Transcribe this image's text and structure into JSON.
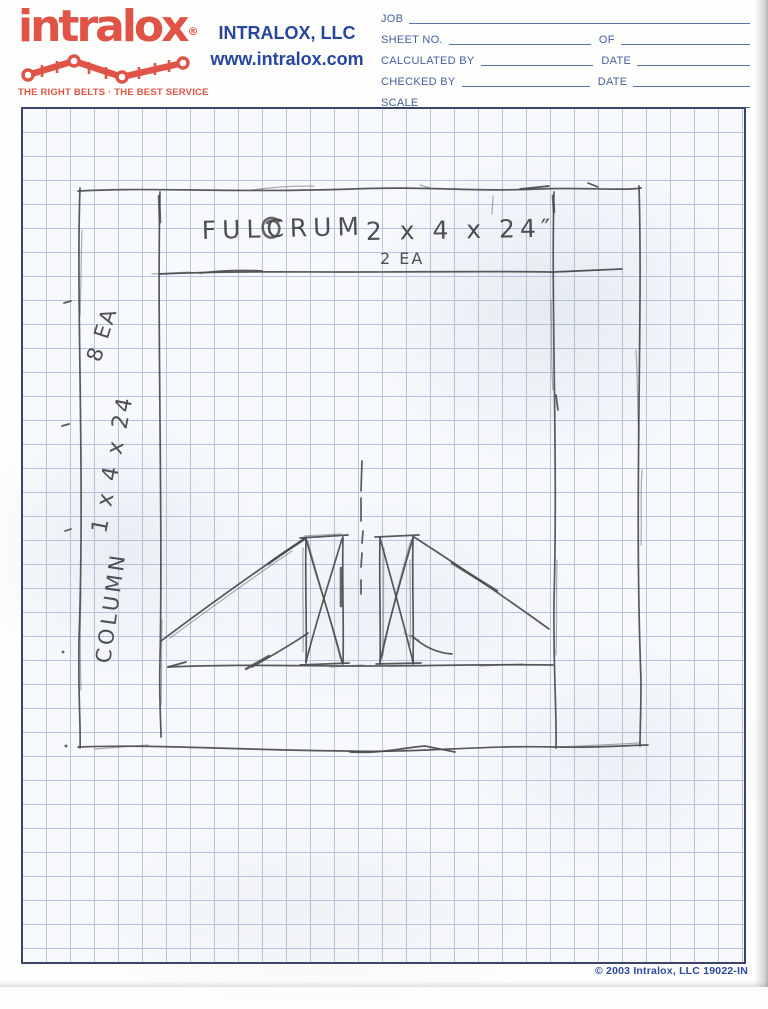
{
  "header": {
    "logo": {
      "brand": "intralox",
      "registered": "®",
      "tagline": "THE RIGHT BELTS · THE BEST SERVICE",
      "belt_icon": "belt-chain-icon"
    },
    "company": {
      "name": "INTRALOX, LLC",
      "website": "www.intralox.com"
    },
    "form": {
      "job_label": "JOB",
      "sheet_label": "SHEET NO.",
      "of_label": "OF",
      "calculated_label": "CALCULATED BY",
      "date_label": "DATE",
      "checked_label": "CHECKED BY",
      "scale_label": "SCALE"
    }
  },
  "sketch": {
    "fulcrum_label": "FULCRUM",
    "fulcrum_size": "2 x 4 x 24″",
    "fulcrum_qty": "2 EA",
    "column_qty": "8 EA",
    "column_size": "1 x 4 x 24",
    "column_label": "COLUMN"
  },
  "footer": {
    "copyright": "© 2003 Intralox, LLC 19022-IN"
  },
  "colors": {
    "brand_red": "#df5447",
    "header_blue": "#27479e",
    "form_blue": "#44609c",
    "grid_border": "#3a4468",
    "grid_line": "#b7c5dc",
    "pencil": "#4b4b4e"
  }
}
